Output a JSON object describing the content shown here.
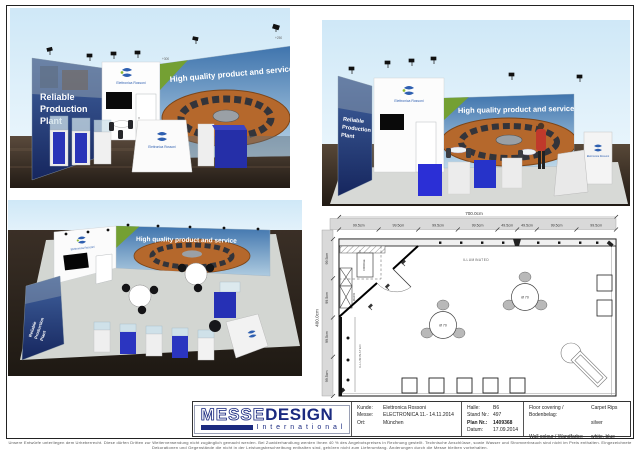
{
  "renders": {
    "banner_text": "High quality product and service",
    "wall_line1": "Reliable",
    "wall_line2": "Production",
    "wall_line3": "Plant",
    "brand_name": "Elettronica Rossoni",
    "height_top": "+300",
    "height_right": "+250"
  },
  "plan": {
    "total_width": "700.0cm",
    "total_height": "400.0cm",
    "top_segments": [
      "99.5cm",
      "99.5cm",
      "99.5cm",
      "99.5cm",
      "49.5cm",
      "49.5cm",
      "99.5cm",
      "99.5cm"
    ],
    "left_segments": [
      "99.5cm",
      "99.5cm",
      "99.5cm",
      "99.5cm"
    ],
    "illuminated": "ILLUMINATED",
    "fridge": "FRIDGE",
    "rack": "RACK",
    "table_dia": "Ø 70"
  },
  "titleblock": {
    "logo_messe": "MESSE",
    "logo_design": "DESIGN",
    "logo_sub": "I n t e r n a t i o n a l",
    "kunde_label": "Kunde:",
    "kunde": "Elettronica Rossoni",
    "messe_label": "Messe:",
    "messe": "ELECTRONICA 11.- 14.11.2014",
    "ort_label": "Ort:",
    "ort": "München",
    "halle_label": "Halle:",
    "halle": "B6",
    "stand_label": "Stand Nr.:",
    "stand": "497",
    "plannr_label": "Plan Nr.:",
    "plannr": "1409368",
    "datum_label": "Datum:",
    "datum": "17.09.2014",
    "floor_label": "Floor covering / Bodenbelag:",
    "floor_value1": "Carpet Rips",
    "floor_value2": "silver",
    "wall_label": "Wall colour / Wandfarbe:",
    "wall_value": "white, blue"
  },
  "footer": {
    "disclaimer": "Unsere Entwürfe unterliegen dem Urheberrecht. Diese dürfen Dritten zur Weiterverwendung nicht zugänglich gemacht werden. Bei Zuwiderhandlung werden Ihnen 40 % des Angebotspreises in Rechnung gestellt. Technische Anschlüsse, sowie Wasser und Stromverbrauch sind nicht im Preis enthalten. Eingezeichnete Dekorationen und Gegenstände die nicht in der Leistungsbeschreibung enthalten sind, gehören nicht zum Lieferumfang. Änderungen durch die Messe bleiben vorbehalten."
  },
  "colors": {
    "navy": "#1b2a80",
    "banner_blue": "#3f74ad",
    "sky": "#d2eaf8",
    "accent_green": "#74a033",
    "machine_orange": "#b5682c",
    "cube_blue": "#2a34b8",
    "graphic_wall_blue": "#27418c",
    "plan_band_gray": "#d9d9d9"
  }
}
